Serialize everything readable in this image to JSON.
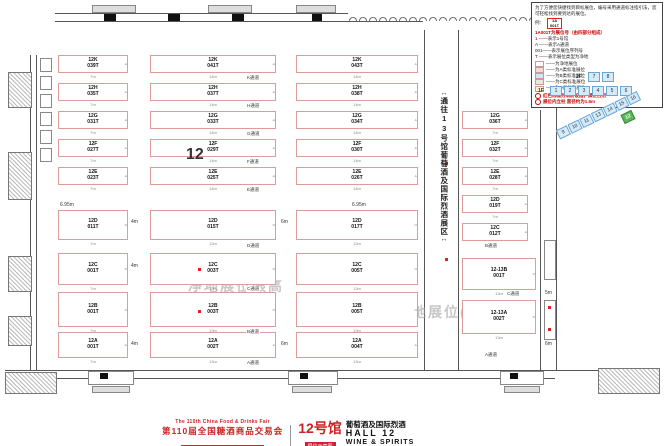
{
  "legend": {
    "intro": "为了方便您快捷找到目标展位，编号采用通道标注指引法，您可轻松找到要到达的展位。",
    "example_label": "例：",
    "sample_booth_line1": "1A",
    "sample_booth_line2": "001T",
    "subtitle": "1A001T为展位号（由四部分组成）",
    "rules": [
      "1 ——表示1号馆",
      "A ——表示A通道",
      "001——表示展位序列号",
      "T ——表示展位类型为净地"
    ],
    "keys": [
      {
        "color": "#ffffff",
        "label": "——为净地展位"
      },
      {
        "color": "#f8d7da",
        "label": "——为A类标准展位"
      },
      {
        "color": "#d6e4f7",
        "label": "——为B类标准展位"
      },
      {
        "color": "#d9f2d9",
        "label": "——为C类标准展位"
      },
      {
        "color": "#fdf3cf",
        "label": "——为D类标准展位"
      }
    ],
    "notes": [
      "红色线框为消防设施，禁止占用",
      "展位内立柱 直径约为1.5m"
    ]
  },
  "navigator": {
    "rows": [
      {
        "label": "2F",
        "halls": [
          "7",
          "8"
        ]
      },
      {
        "label": "1F",
        "halls": [
          "1",
          "2",
          "3",
          "4",
          "5",
          "6"
        ]
      }
    ],
    "wing_halls": [
      "9",
      "10",
      "11",
      "13",
      "14",
      "15",
      "16"
    ],
    "current_hall": "12",
    "cell_color": "#d6eaf8",
    "current_color": "#5cb85c"
  },
  "corridor": {
    "arrow_top": "↔",
    "text": "通往13号馆葡萄酒及国际烈酒展区",
    "arrow_bottom": "↔"
  },
  "plan": {
    "hall_number": "12",
    "watermarks": [
      {
        "text": "净地展位限高",
        "x": 188,
        "y": 276
      },
      {
        "text": "净地展位(12-13)高",
        "x": 396,
        "y": 302
      }
    ],
    "booths": [
      {
        "l1": "12K",
        "l2": "039T",
        "x": 58,
        "y": 55,
        "w": 70,
        "h": 18,
        "size": "7m",
        "d": "4"
      },
      {
        "l1": "12K",
        "l2": "041T",
        "x": 150,
        "y": 55,
        "w": 126,
        "h": 18,
        "size": "14m",
        "d": "4"
      },
      {
        "l1": "12K",
        "l2": "043T",
        "x": 296,
        "y": 55,
        "w": 122,
        "h": 18,
        "size": "14m",
        "d": "4"
      },
      {
        "l1": "12H",
        "l2": "035T",
        "x": 58,
        "y": 83,
        "w": 70,
        "h": 18,
        "size": "7m",
        "d": "4"
      },
      {
        "l1": "12H",
        "l2": "037T",
        "x": 150,
        "y": 83,
        "w": 126,
        "h": 18,
        "size": "14m",
        "d": "4"
      },
      {
        "l1": "12H",
        "l2": "038T",
        "x": 296,
        "y": 83,
        "w": 122,
        "h": 18,
        "size": "14m",
        "d": "4"
      },
      {
        "l1": "12G",
        "l2": "031T",
        "x": 58,
        "y": 111,
        "w": 70,
        "h": 18,
        "size": "7m",
        "d": "4"
      },
      {
        "l1": "12G",
        "l2": "033T",
        "x": 150,
        "y": 111,
        "w": 126,
        "h": 18,
        "size": "14m",
        "d": "4"
      },
      {
        "l1": "12G",
        "l2": "034T",
        "x": 296,
        "y": 111,
        "w": 122,
        "h": 18,
        "size": "14m",
        "d": "4"
      },
      {
        "l1": "12G",
        "l2": "036T",
        "x": 462,
        "y": 111,
        "w": 66,
        "h": 18,
        "size": "7m",
        "d": "4"
      },
      {
        "l1": "12F",
        "l2": "027T",
        "x": 58,
        "y": 139,
        "w": 70,
        "h": 18,
        "size": "7m",
        "d": "4"
      },
      {
        "l1": "12F",
        "l2": "029T",
        "x": 150,
        "y": 139,
        "w": 126,
        "h": 18,
        "size": "14m",
        "d": "4"
      },
      {
        "l1": "12F",
        "l2": "030T",
        "x": 296,
        "y": 139,
        "w": 122,
        "h": 18,
        "size": "14m",
        "d": "4"
      },
      {
        "l1": "12F",
        "l2": "032T",
        "x": 462,
        "y": 139,
        "w": 66,
        "h": 18,
        "size": "7m",
        "d": "4"
      },
      {
        "l1": "12E",
        "l2": "023T",
        "x": 58,
        "y": 167,
        "w": 70,
        "h": 18,
        "size": "7m",
        "d": "4"
      },
      {
        "l1": "12E",
        "l2": "025T",
        "x": 150,
        "y": 167,
        "w": 126,
        "h": 18,
        "size": "14m",
        "d": "4"
      },
      {
        "l1": "12E",
        "l2": "026T",
        "x": 296,
        "y": 167,
        "w": 122,
        "h": 18,
        "size": "14m",
        "d": "4"
      },
      {
        "l1": "12E",
        "l2": "028T",
        "x": 462,
        "y": 167,
        "w": 66,
        "h": 18,
        "size": "7m",
        "d": "4"
      },
      {
        "l1": "12D",
        "l2": "011T",
        "x": 58,
        "y": 210,
        "w": 70,
        "h": 30,
        "size": "7m",
        "d": "6"
      },
      {
        "l1": "12D",
        "l2": "015T",
        "x": 150,
        "y": 210,
        "w": 126,
        "h": 30,
        "size": "12m",
        "d": "6"
      },
      {
        "l1": "12D",
        "l2": "017T",
        "x": 296,
        "y": 210,
        "w": 122,
        "h": 30,
        "size": "12m",
        "d": "6"
      },
      {
        "l1": "12D",
        "l2": "019T",
        "x": 462,
        "y": 195,
        "w": 66,
        "h": 18,
        "size": "7m",
        "d": "4"
      },
      {
        "l1": "12C",
        "l2": "001T",
        "x": 58,
        "y": 253,
        "w": 70,
        "h": 32,
        "size": "7m",
        "d": "6"
      },
      {
        "l1": "12C",
        "l2": "003T",
        "x": 150,
        "y": 253,
        "w": 126,
        "h": 32,
        "size": "13m",
        "d": "6"
      },
      {
        "l1": "12C",
        "l2": "005T",
        "x": 296,
        "y": 253,
        "w": 122,
        "h": 32,
        "size": "13m",
        "d": "6"
      },
      {
        "l1": "12C",
        "l2": "012T",
        "x": 462,
        "y": 223,
        "w": 66,
        "h": 18,
        "size": "7m",
        "d": "4"
      },
      {
        "l1": "12B",
        "l2": "001T",
        "x": 58,
        "y": 292,
        "w": 70,
        "h": 35,
        "size": "7m",
        "d": "6"
      },
      {
        "l1": "12B",
        "l2": "003T",
        "x": 150,
        "y": 292,
        "w": 126,
        "h": 35,
        "size": "13m",
        "d": "6"
      },
      {
        "l1": "12B",
        "l2": "005T",
        "x": 296,
        "y": 292,
        "w": 122,
        "h": 35,
        "size": "13m",
        "d": "6"
      },
      {
        "l1": "12A",
        "l2": "001T",
        "x": 58,
        "y": 332,
        "w": 70,
        "h": 26,
        "size": "7m",
        "d": "4"
      },
      {
        "l1": "12A",
        "l2": "002T",
        "x": 150,
        "y": 332,
        "w": 126,
        "h": 26,
        "size": "13m",
        "d": "4"
      },
      {
        "l1": "12A",
        "l2": "004T",
        "x": 296,
        "y": 332,
        "w": 122,
        "h": 26,
        "size": "13m",
        "d": "4"
      },
      {
        "l1": "12-13B",
        "l2": "001T",
        "x": 462,
        "y": 258,
        "w": 74,
        "h": 32,
        "size": "13m",
        "d": "6"
      },
      {
        "l1": "12-13A",
        "l2": "002T",
        "x": 462,
        "y": 300,
        "w": 74,
        "h": 34,
        "size": "13m",
        "d": "6"
      }
    ],
    "aisles": [
      {
        "label": "K通道",
        "x": 246,
        "y": 75
      },
      {
        "label": "H通道",
        "x": 246,
        "y": 103
      },
      {
        "label": "G通道",
        "x": 246,
        "y": 131
      },
      {
        "label": "F通道",
        "x": 246,
        "y": 159
      },
      {
        "label": "E通道",
        "x": 246,
        "y": 187
      },
      {
        "label": "D通道",
        "x": 246,
        "y": 243
      },
      {
        "label": "C通道",
        "x": 246,
        "y": 286
      },
      {
        "label": "B通道",
        "x": 246,
        "y": 329
      },
      {
        "label": "A通道",
        "x": 246,
        "y": 360
      },
      {
        "label": "B通道",
        "x": 484,
        "y": 243
      },
      {
        "label": "C通道",
        "x": 506,
        "y": 291
      },
      {
        "label": "A通道",
        "x": 484,
        "y": 352
      }
    ],
    "dims": [
      {
        "label": "6.95m",
        "x": 60,
        "y": 202
      },
      {
        "label": "6.95m",
        "x": 352,
        "y": 202
      },
      {
        "label": "4m",
        "x": 131,
        "y": 219
      },
      {
        "label": "6m",
        "x": 281,
        "y": 219
      },
      {
        "label": "4m",
        "x": 131,
        "y": 263
      },
      {
        "label": "4m",
        "x": 131,
        "y": 341
      },
      {
        "label": "6m",
        "x": 281,
        "y": 341
      },
      {
        "label": "5m",
        "x": 545,
        "y": 290
      },
      {
        "label": "6m",
        "x": 545,
        "y": 341
      }
    ],
    "markers": [
      {
        "x": 198,
        "y": 268
      },
      {
        "x": 198,
        "y": 310
      },
      {
        "x": 445,
        "y": 162
      },
      {
        "x": 445,
        "y": 258
      },
      {
        "x": 548,
        "y": 306
      },
      {
        "x": 548,
        "y": 328
      }
    ]
  },
  "title_block": {
    "en_line": "The 110th China Food & Drinks Fair",
    "zh_line": "第110届全国糖酒商品交易会",
    "venue": "中国西部国际博览城（成都）",
    "badge": "展位示意图",
    "hall_cn": "12号馆",
    "hall_sub": "葡萄酒及国际烈酒",
    "hall_en": "HALL 12",
    "hall_en2": "WINE & SPIRITS"
  }
}
